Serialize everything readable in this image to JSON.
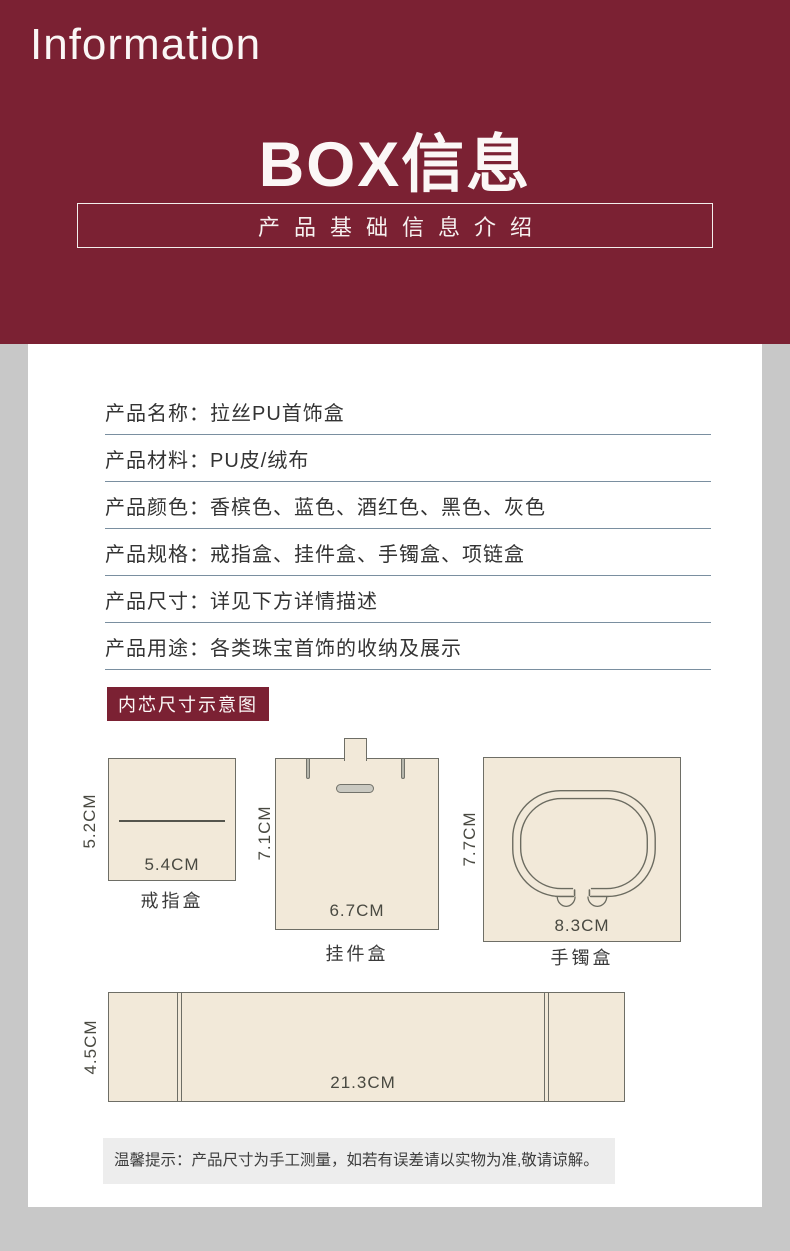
{
  "colors": {
    "maroon": "#7b2133",
    "page_bg": "#c8c8c8",
    "card_bg": "#ffffff",
    "beige_box": "#f2e9d9",
    "table_rule": "#7a8fa0"
  },
  "header": {
    "eyebrow": "Information",
    "title": "BOX信息",
    "subtitle": "产品基础信息介绍"
  },
  "specs": {
    "rows": [
      {
        "label": "产品名称：",
        "value": "拉丝PU首饰盒"
      },
      {
        "label": "产品材料：",
        "value": "PU皮/绒布"
      },
      {
        "label": "产品颜色：",
        "value": "香槟色、蓝色、酒红色、黑色、灰色"
      },
      {
        "label": "产品规格：",
        "value": "戒指盒、挂件盒、手镯盒、项链盒"
      },
      {
        "label": "产品尺寸：",
        "value": "详见下方详情描述"
      },
      {
        "label": "产品用途：",
        "value": "各类珠宝首饰的收纳及展示"
      }
    ]
  },
  "diagrams": {
    "section_title": "内芯尺寸示意图",
    "ring": {
      "name": "戒指盒",
      "width_label": "5.4CM",
      "height_label": "5.2CM"
    },
    "pendant": {
      "name": "挂件盒",
      "width_label": "6.7CM",
      "height_label": "7.1CM"
    },
    "bangle": {
      "name": "手镯盒",
      "width_label": "8.3CM",
      "height_label": "7.7CM"
    },
    "necklace": {
      "width_label": "21.3CM",
      "height_label": "4.5CM"
    }
  },
  "note": {
    "text": "温馨提示：产品尺寸为手工测量，如若有误差请以实物为准,敬请谅解。"
  }
}
